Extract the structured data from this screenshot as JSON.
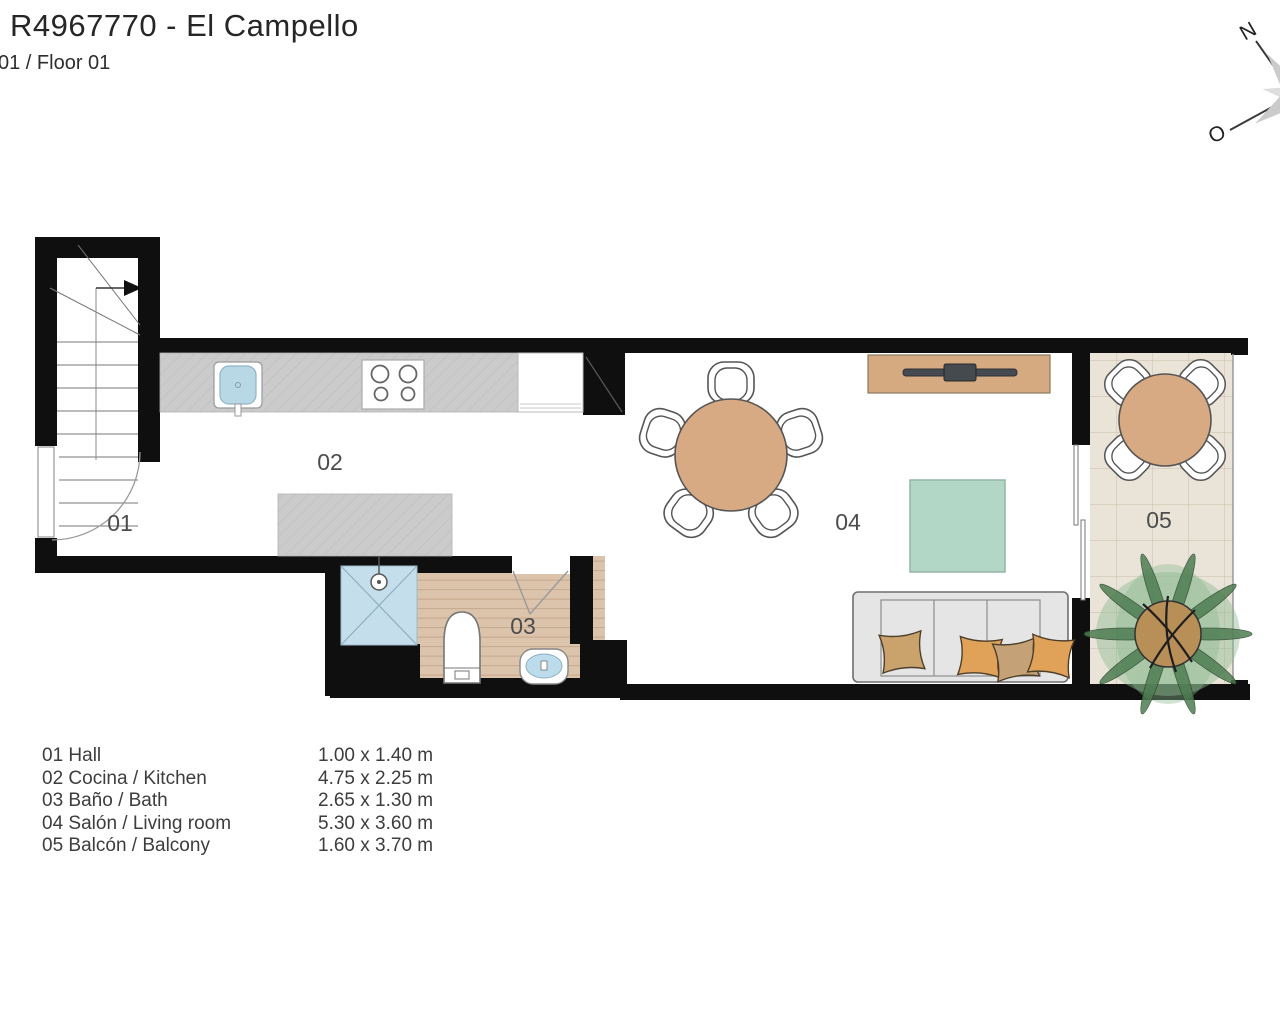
{
  "header": {
    "title": "R4967770 - El Campello",
    "subtitle": "01 / Floor 01"
  },
  "compass": {
    "north": "N",
    "west": "O"
  },
  "plan": {
    "room_labels": [
      "01",
      "02",
      "03",
      "04",
      "05"
    ]
  },
  "legend": {
    "rows": [
      {
        "label": "01 Hall",
        "size": "1.00 x 1.40 m"
      },
      {
        "label": "02 Cocina / Kitchen",
        "size": "4.75 x 2.25 m"
      },
      {
        "label": "03 Baño / Bath",
        "size": "2.65 x 1.30 m"
      },
      {
        "label": "04 Salón / Living room",
        "size": "5.30 x 3.60 m"
      },
      {
        "label": "05 Balcón / Balcony",
        "size": "1.60 x 3.70 m"
      }
    ]
  },
  "colors": {
    "wall": "#0f0f0f",
    "counter_gray": "#cbcbcb",
    "bath_floor": "#dcc3ac",
    "balcony_tile": "#eae3d7",
    "wood": "#d6aa81",
    "rug_teal": "#b3d7c6",
    "water_blue": "#c3dcea",
    "sofa_gray": "#e5e5e5",
    "pillow_orange": "#e0a258",
    "pillow_tan": "#c9a26c",
    "palm_green": "#4e7d52"
  }
}
